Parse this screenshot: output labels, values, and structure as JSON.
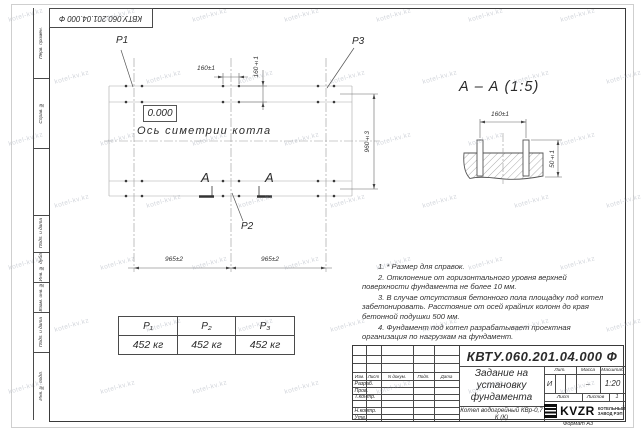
{
  "watermark": "kotel-kv.kz",
  "left_column": {
    "perv_primen": "Перв. примен.",
    "sprav_no": "Справ. №",
    "podp_data_1": "Подп. и дата",
    "inv_dubl": "Инв. № дубл.",
    "vzam_inv": "Взам. инв. №",
    "podp_data_2": "Подп. и дата",
    "inv_podl": "Инв. № подл."
  },
  "plan": {
    "p1": "P1",
    "p2": "P2",
    "p3": "P3",
    "elevation": "0.000",
    "axis_label": "Ось симетрии котла",
    "section_letter": "А",
    "dim_bolt_h": "160±1",
    "dim_bolt_v": "160±1",
    "dim_width": "960±3",
    "dim_span_left": "965±2",
    "dim_span_right": "965±2"
  },
  "section": {
    "title": "А – А (1:5)",
    "dim_bolts": "160±1",
    "dim_height": "50±1"
  },
  "load_table": {
    "headers": [
      "Р₁",
      "Р₂",
      "Р₃"
    ],
    "values": [
      "452 кг",
      "452 кг",
      "452 кг"
    ]
  },
  "notes": [
    "1. * Размер для справок.",
    "2. Отклонение от горизонтального уровня верхней поверхности фундамента не более 10 мм.",
    "3. В случае отсутствия бетонного пола площадку под котел забетонировать. Расстояние от осей крайних колонн до края бетонной подушки 500 мм.",
    "4. Фундамент под котел разрабатывает проектная организация по нагрузкам на фундамент."
  ],
  "title_block": {
    "doc_number": "КВТУ.060.201.04.000  Ф",
    "title": "Задание на установку фундамента",
    "product": "Котел водогрейный КВр-0,7 К (К)",
    "columns": {
      "izm": "Изм.",
      "list": "Лист",
      "doc": "N докум.",
      "podp": "Подп.",
      "data": "Дата"
    },
    "roles": {
      "razrab": "Разраб.",
      "prov": "Пров.",
      "tkontr": "Т.контр.",
      "nkontr": "Н.контр.",
      "utv": "Утв."
    },
    "lit_label": "Лит.",
    "lit_value": "И",
    "mass_label": "Масса",
    "mass_value": "–",
    "scale_label": "Масштаб",
    "scale_value": "1:20",
    "sheet_label": "Лист",
    "sheets_label": "Листов",
    "sheets_value": "1",
    "logo": {
      "name": "KVZR",
      "sub1": "КОТЕЛЬНЫЙ",
      "sub2": "ЗАВОД РЭП"
    },
    "format": "Формат А3"
  },
  "colors": {
    "drawing_line": "#555555",
    "logo_black": "#0d0d0d"
  }
}
